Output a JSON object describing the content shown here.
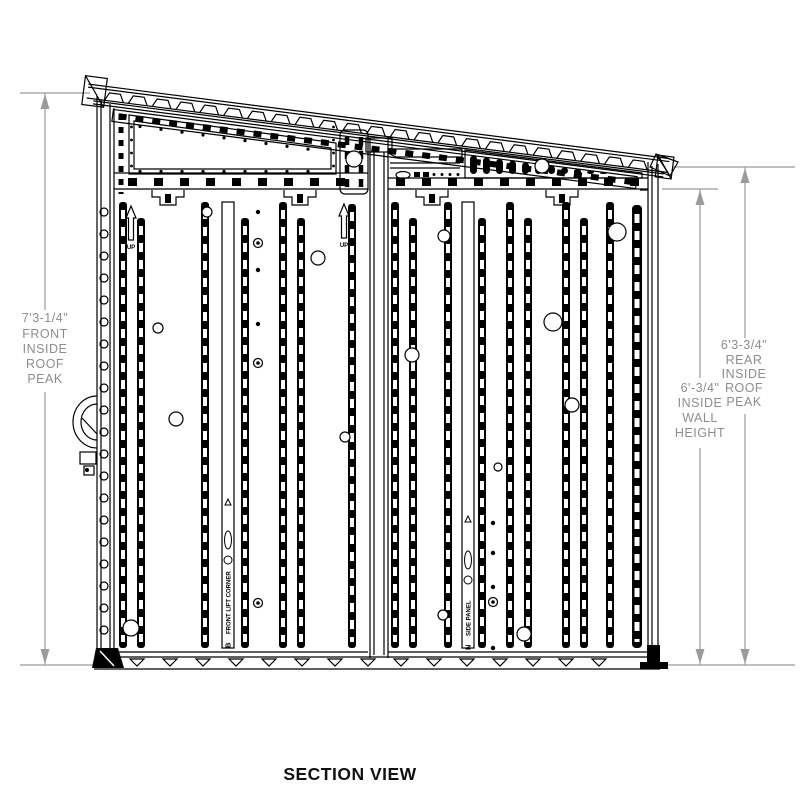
{
  "title": "SECTION VIEW",
  "dimensions": {
    "front_roof_peak": {
      "value": "7'3-1/4\"",
      "line1": "FRONT",
      "line2": "INSIDE",
      "line3": "ROOF",
      "line4": "PEAK"
    },
    "inside_wall_height": {
      "value": "6'-3/4\"",
      "line1": "INSIDE",
      "line2": "WALL",
      "line3": "HEIGHT"
    },
    "rear_roof_peak": {
      "value": "6'3-3/4\"",
      "line1": "REAR",
      "line2": "INSIDE",
      "line3": "ROOF",
      "line4": "PEAK"
    }
  },
  "part_labels": {
    "up": "UP",
    "front_lift_corner_marker": "B",
    "front_lift_corner": "FRONT LIFT CORNER",
    "side_panel_marker": "N",
    "side_panel": "SIDE PANEL"
  },
  "colors": {
    "line": "#000000",
    "dimension_line": "#9b9b9b",
    "dimension_text": "#8d8d8d",
    "background": "#ffffff"
  }
}
